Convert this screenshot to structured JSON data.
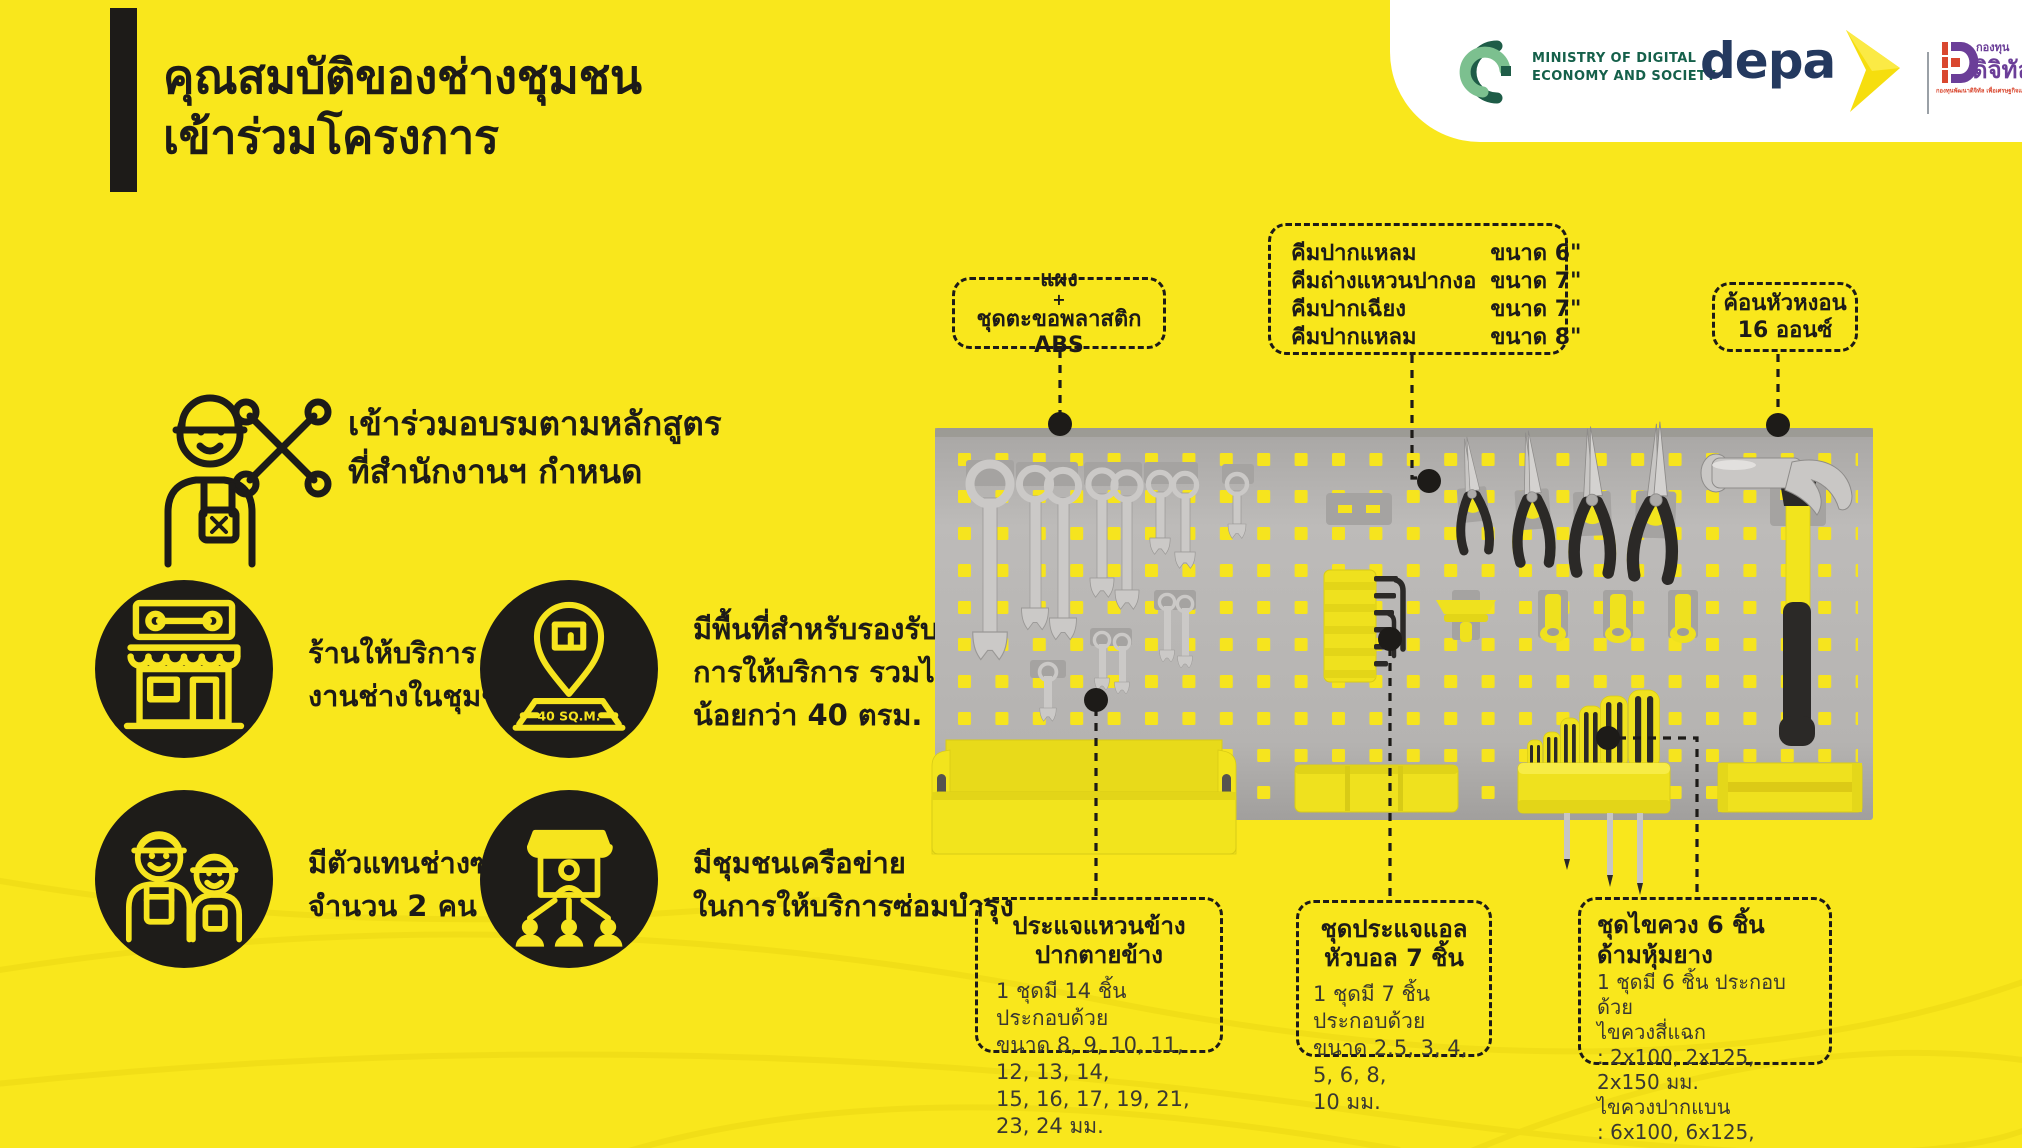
{
  "colors": {
    "background": "#F9E71C",
    "ink": "#1D1B18",
    "board_gray": "#B7B5B3",
    "tool_yellow": "#F2E41D",
    "depa_navy": "#24395F",
    "mdes_green": "#15604A",
    "fund_purple": "#6B3E98",
    "fund_red": "#D9472F"
  },
  "header": {
    "title_line1": "คุณสมบัติของช่างชุมชน",
    "title_line2": "เข้าร่วมโครงการ"
  },
  "logos": {
    "mdes": {
      "line1": "MINISTRY OF DIGITAL",
      "line2": "ECONOMY AND SOCIETY"
    },
    "depa": {
      "wordmark": "depa"
    },
    "fund": {
      "thai_top": "กองทุน",
      "thai_main": "ดิจิทัล",
      "tagline": "กองทุนพัฒนาดิจิทัล เพื่อเศรษฐกิจและสังคม"
    }
  },
  "training": {
    "line1": "เข้าร่วมอบรมตามหลักสูตร",
    "line2": "ที่สำนักงานฯ กำหนด"
  },
  "qualifications": [
    {
      "line1": "ร้านให้บริการ",
      "line2": "งานช่างในชุมชน"
    },
    {
      "line1": "มีพื้นที่สำหรับรองรับ",
      "line2": "การให้บริการ รวมไม่",
      "line3": "น้อยกว่า 40 ตรม.",
      "icon_label": "40 SQ.M."
    },
    {
      "line1": "มีตัวแทนช่างซ่อม",
      "line2": "จำนวน 2 คน"
    },
    {
      "line1": "มีชุมชนเครือข่าย",
      "line2": "ในการให้บริการซ่อมบำรุง"
    }
  ],
  "callouts": {
    "panel": {
      "line1": "แผง",
      "line2": "+",
      "line3": "ชุดตะขอพลาสติก ABS"
    },
    "pliers": {
      "rows": [
        {
          "name": "คีมปากแหลม",
          "size": "ขนาด 6\""
        },
        {
          "name": "คีมถ่างแหวนปากงอ",
          "size": "ขนาด 7\""
        },
        {
          "name": "คีมปากเฉียง",
          "size": "ขนาด 7\""
        },
        {
          "name": "คีมปากแหลม",
          "size": "ขนาด 8\""
        }
      ]
    },
    "hammer": {
      "line1": "ค้อนหัวหงอน",
      "line2": "16 ออนซ์"
    },
    "wrench_set": {
      "title1": "ประแจแหวนข้าง",
      "title2": "ปากตายข้าง",
      "body1": "1 ชุดมี 14 ชิ้น ประกอบด้วย",
      "body2": "ขนาด 8, 9, 10, 11, 12, 13, 14,",
      "body3": "15, 16, 17, 19, 21, 23, 24 มม."
    },
    "hex_set": {
      "title1": "ชุดประแจแอล",
      "title2": "หัวบอล 7 ชิ้น",
      "body1": "1 ชุดมี 7 ชิ้น ประกอบด้วย",
      "body2": "ขนาด 2.5, 3, 4, 5, 6, 8,",
      "body3": "10 มม."
    },
    "screwdriver_set": {
      "title": "ชุดไขควง 6 ชิ้น ด้ามหุ้มยาง",
      "body1": "1 ชุดมี 6 ชิ้น ประกอบด้วย",
      "body2": "ไขควงสี่แฉก",
      "body3": ": 2x100, 2x125, 2x150 มม.",
      "body4": "ไขควงปากแบน",
      "body5": ": 6x100, 6x125, 6x150 มม."
    }
  }
}
